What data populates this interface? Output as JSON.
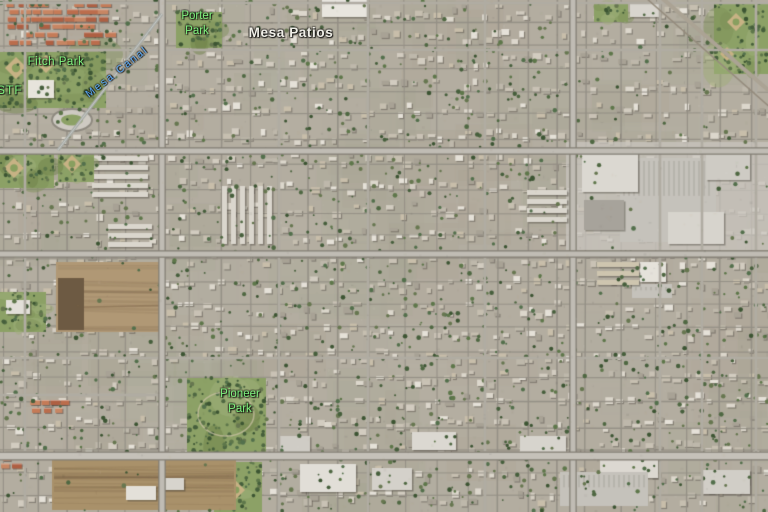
{
  "map": {
    "imagery_type": "satellite",
    "label_colors": {
      "park": "#7ef27e",
      "waterway": "#57a6f4",
      "neighborhood": "#f0efe8"
    },
    "labels": [
      {
        "id": "porter-park",
        "lines": [
          "Porter",
          "Park"
        ],
        "category": "park",
        "x": 197,
        "y": 9,
        "align": "center",
        "font_size": 11.5,
        "line_height": 14.5
      },
      {
        "id": "mesa-patios",
        "lines": [
          "Mesa Patios"
        ],
        "category": "neighborhood",
        "x": 291,
        "y": 25,
        "align": "center",
        "font_size": 13.5,
        "bold": true,
        "letter_spacing": 0.6
      },
      {
        "id": "fitch-park",
        "lines": [
          "Fitch Park"
        ],
        "category": "park",
        "x": 56,
        "y": 56,
        "align": "center",
        "font_size": 11.5,
        "letter_spacing": 0.5
      },
      {
        "id": "mesa-canal",
        "lines": [
          "Mesa Canal"
        ],
        "category": "waterway",
        "x": 117,
        "y": 66,
        "align": "center",
        "rotation": -38,
        "font_size": 10.5,
        "letter_spacing": 2
      },
      {
        "id": "stf-partial",
        "lines": [
          "STF"
        ],
        "category": "park",
        "x": -3,
        "y": 83,
        "align": "left",
        "font_size": 12,
        "letter_spacing": 1
      },
      {
        "id": "pioneer-park",
        "lines": [
          "Pioneer",
          "Park"
        ],
        "category": "park",
        "x": 240,
        "y": 387,
        "align": "center",
        "font_size": 11.5,
        "line_height": 15
      }
    ]
  }
}
